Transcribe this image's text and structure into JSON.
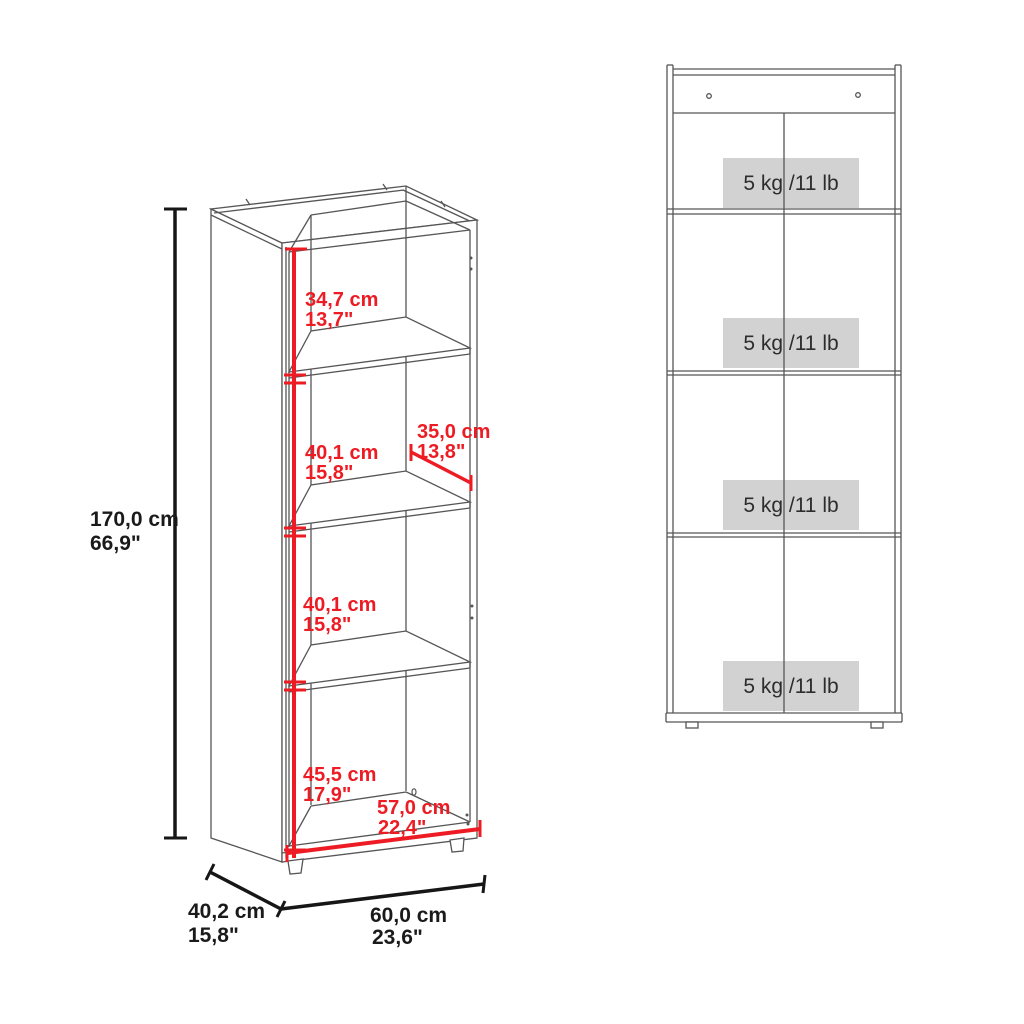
{
  "iso_view": {
    "overall_height_cm": "170,0 cm",
    "overall_height_in": "66,9\"",
    "compartments": [
      {
        "cm": "34,7 cm",
        "in": "13,7\""
      },
      {
        "cm": "40,1 cm",
        "in": "15,8\""
      },
      {
        "cm": "40,1 cm",
        "in": "15,8\""
      },
      {
        "cm": "45,5 cm",
        "in": "17,9\""
      }
    ],
    "shelf_depth_cm": "35,0 cm",
    "shelf_depth_in": "13,8\"",
    "interior_width_cm": "57,0 cm",
    "interior_width_in": "22,4\"",
    "overall_depth_cm": "40,2 cm",
    "overall_depth_in": "15,8\"",
    "overall_width_cm": "60,0 cm",
    "overall_width_in": "23,6\""
  },
  "front_view": {
    "capacity_labels": [
      "5 kg /11 lb",
      "5 kg /11 lb",
      "5 kg /11 lb",
      "5 kg /11 lb"
    ]
  },
  "colors": {
    "dimension_red": "#ed1c24",
    "line_gray": "#565656",
    "dimension_black": "#161616",
    "badge_gray": "#d2d2d2"
  }
}
